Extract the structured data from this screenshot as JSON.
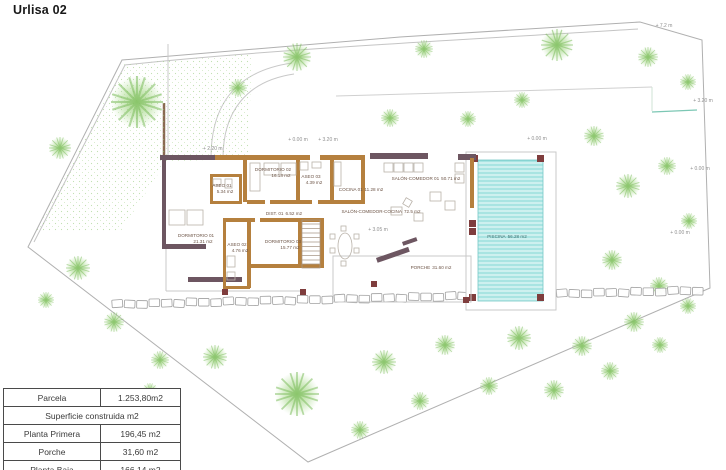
{
  "title": "Urlisa 02",
  "colors": {
    "first_floor_wall": "#6d5661",
    "ground_floor_wall": "#b5803e",
    "pool_water": "#cdf0ef",
    "pool_stripe": "#84d8d6",
    "tree_green": "#8cc868",
    "pillar": "#7f3d3d"
  },
  "rooms": {
    "dormitorio_01": {
      "name": "DORMITORIO 01",
      "area": "21.31 m2"
    },
    "dormitorio_02": {
      "name": "DORMITORIO 02",
      "area": "16.18 m2"
    },
    "dormitorio_03": {
      "name": "DORMITORIO 03",
      "area": "15.77 m2"
    },
    "aseo_01": {
      "name": "ASEO 01",
      "area": "5.34 m2"
    },
    "aseo_02": {
      "name": "ASEO 02",
      "area": "4.76 m2"
    },
    "aseo_03": {
      "name": "ASEO 03",
      "area": "4.39 m2"
    },
    "cocina_01": {
      "name": "COCINA 01",
      "area": "11.28 m2"
    },
    "salon_comedor_01": {
      "name": "SALÓN-COMEDOR 01",
      "area": "50.71 m2"
    },
    "salon_comedor_cocina": {
      "name": "SALÓN-COMEDOR-COCINA",
      "area": "72.5 m2"
    },
    "dist_01": {
      "name": "DIST. 01",
      "area": "6.52 m2"
    },
    "porche": {
      "name": "PORCHE",
      "area": "31.60 m2"
    },
    "piscina": {
      "name": "PISCINA",
      "area": "56.28 m2"
    }
  },
  "levels": {
    "left": "+ 2.20 m",
    "top_a": "+ 0.00 m",
    "top_b": "+ 3.20 m",
    "top_c": "+ 0.00 m",
    "top_right": "+ 7.2 m",
    "right_a": "+ 3.20 m",
    "right_b": "+ 0.00 m",
    "right_c": "+ 0.00 m",
    "porch": "+ 3.05 m"
  },
  "table": {
    "parcela": {
      "label": "Parcela",
      "value": "1.253,80m2"
    },
    "section_header": "Superficie construida m2",
    "planta_primera": {
      "label": "Planta Primera",
      "value": "196,45 m2"
    },
    "porche": {
      "label": "Porche",
      "value": "31,60 m2"
    },
    "planta_baja": {
      "label": "Planta Baja",
      "value": "166,14 m2"
    }
  }
}
